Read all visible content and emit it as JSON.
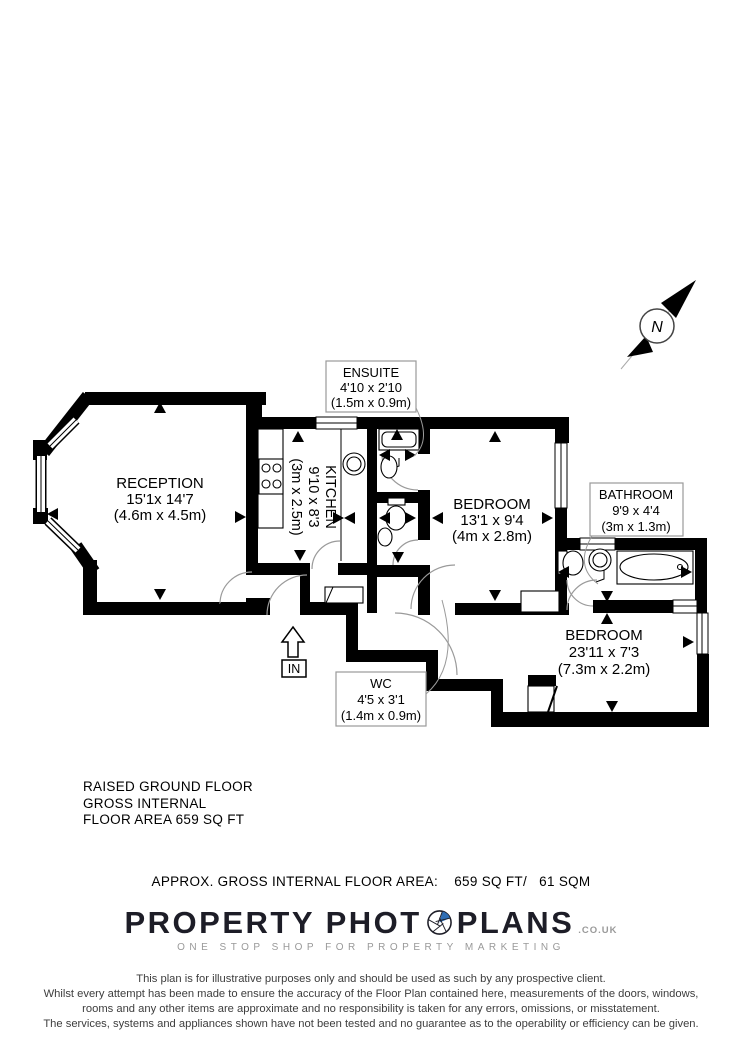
{
  "plan": {
    "rooms": {
      "reception": {
        "name": "RECEPTION",
        "imperial": "15'1x 14'7",
        "metric": "(4.6m x 4.5m)"
      },
      "kitchen": {
        "name": "KITCHEN",
        "imperial": "9'10 x 8'3",
        "metric": "(3m x 2.5m)"
      },
      "ensuite": {
        "name": "ENSUITE",
        "imperial": "4'10 x 2'10",
        "metric": "(1.5m x 0.9m)"
      },
      "bedroom1": {
        "name": "BEDROOM",
        "imperial": "13'1 x 9'4",
        "metric": "(4m x 2.8m)"
      },
      "bathroom": {
        "name": "BATHROOM",
        "imperial": "9'9 x 4'4",
        "metric": "(3m x 1.3m)"
      },
      "bedroom2": {
        "name": "BEDROOM",
        "imperial": "23'11 x 7'3",
        "metric": "(7.3m x 2.2m)"
      },
      "wc": {
        "name": "WC",
        "imperial": "4'5 x 3'1",
        "metric": "(1.4m x 0.9m)"
      }
    },
    "entrance_label": "IN",
    "compass_label": "N"
  },
  "floor_summary": {
    "line1": "RAISED GROUND FLOOR",
    "line2": "GROSS INTERNAL",
    "line3": "FLOOR AREA 659 SQ FT"
  },
  "area_line": "APPROX. GROSS INTERNAL FLOOR AREA:    659 SQ FT/   61 SQM",
  "logo": {
    "part1": "PROPERTY PHOT",
    "part2": "PLANS",
    "suffix": ".CO.UK",
    "tagline": "ONE STOP SHOP FOR PROPERTY MARKETING"
  },
  "disclaimer": [
    "This plan is for illustrative purposes only and should be used as such by any prospective client.",
    "Whilst every attempt has been made to ensure the accuracy of the Floor Plan contained here, measurements of the doors, windows,",
    "rooms and any other items are approximate and no responsibility is taken for any errors, omissions, or misstatement.",
    "The services, systems and appliances shown have not been tested and no guarantee as to the operability or efficiency can be given."
  ],
  "colors": {
    "ink": "#000000",
    "logo_ink": "#1d1d27",
    "accent_blue": "#2e6db4",
    "muted_gray": "#999999"
  }
}
